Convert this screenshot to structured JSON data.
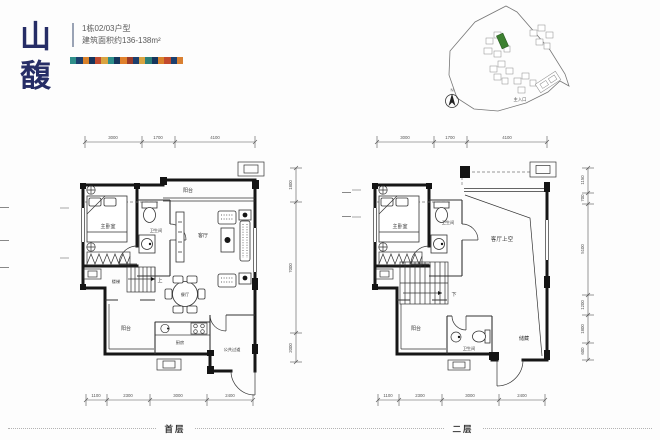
{
  "header": {
    "logo": "山馥",
    "title_line1": "1栋02/03户型",
    "title_line2": "建筑面积约136-138m²"
  },
  "colors": {
    "logo": "#262d66",
    "site_highlight": "#3c8030"
  },
  "decor_strip_colors": [
    "#2f8f8a",
    "#1c3f6e",
    "#d9822b",
    "#16355c",
    "#c24a2e",
    "#d9a441",
    "#2f8f8a",
    "#16355c",
    "#e0812c",
    "#9c3b2a",
    "#1c3f6e",
    "#d9a441",
    "#2a7f7a",
    "#16355c",
    "#d9822b",
    "#c24a2e",
    "#1c3f6e",
    "#d98032"
  ],
  "site_plan": {
    "entrance_label": "主入口",
    "north_label": "N"
  },
  "floor1": {
    "label": "首层",
    "dims_top": [
      "3000",
      "1700",
      "4100"
    ],
    "dims_bottom": [
      "1100",
      "2300",
      "3000",
      "2400"
    ],
    "dims_right": [
      "1800",
      "7000",
      "2000"
    ],
    "rooms": {
      "master_bedroom": "主卧室",
      "bathroom": "卫生间",
      "balcony_top": "阳台",
      "living_room": "客厅",
      "stairs": "楼梯",
      "stairs_up": "上",
      "dining": "餐厅",
      "balcony_bottom": "阳台",
      "kitchen": "厨房",
      "corridor": "公共过道"
    }
  },
  "floor2": {
    "label": "二层",
    "dims_top": [
      "3000",
      "1700",
      "4100"
    ],
    "dims_bottom": [
      "1100",
      "2300",
      "3000",
      "2400"
    ],
    "dims_right": [
      "1150",
      "700",
      "5100",
      "1200",
      "1800",
      "600"
    ],
    "rooms": {
      "master_bedroom": "主卧室",
      "bathroom": "卫生间",
      "living_void": "客厅上空",
      "stairs_down": "下",
      "balcony": "阳台",
      "bathroom2": "卫生间",
      "storage": "储藏"
    }
  }
}
